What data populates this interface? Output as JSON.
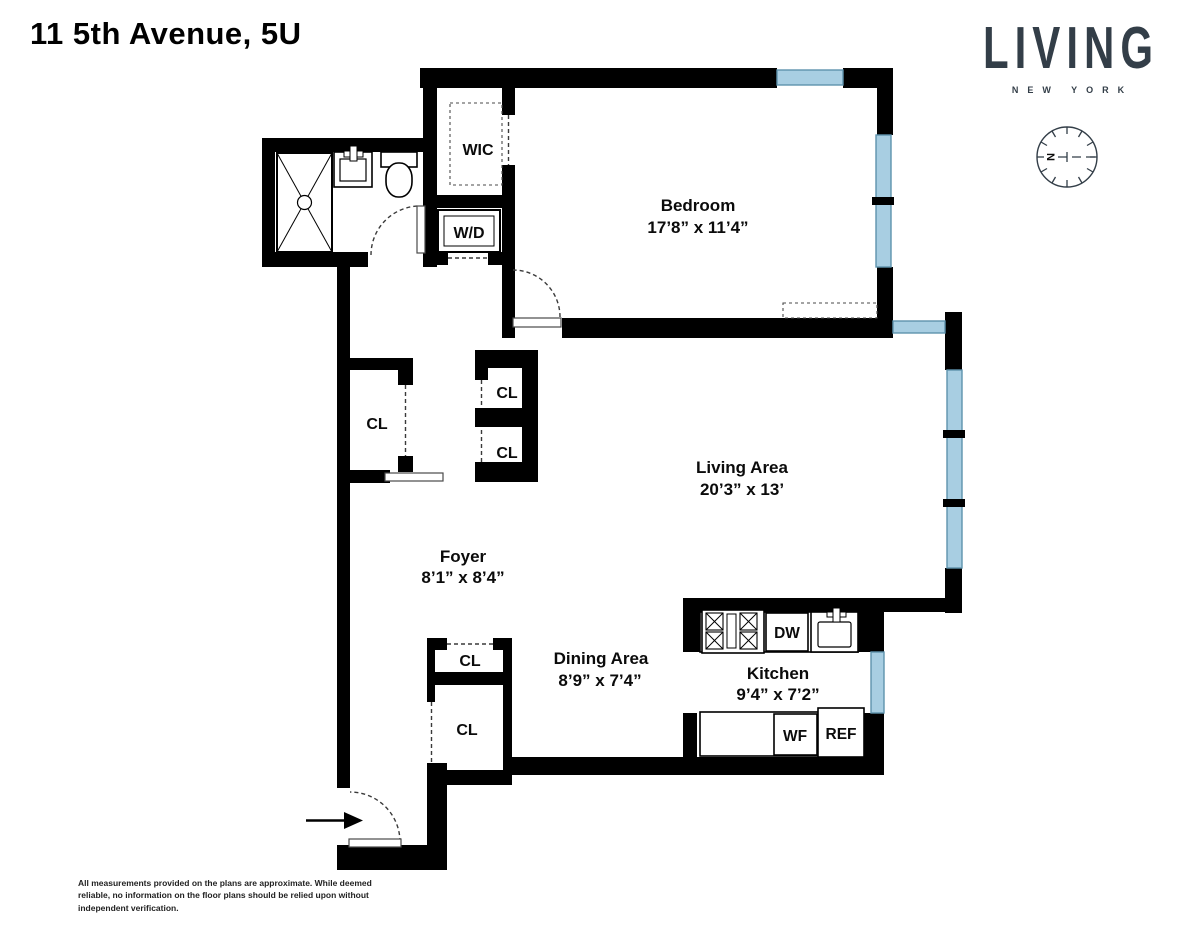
{
  "header": {
    "title": "11 5th Avenue, 5U"
  },
  "logo": {
    "brand": "LIVING",
    "tagline": "NEW YORK",
    "color": "#333E48"
  },
  "compass": {
    "north": "N"
  },
  "rooms": {
    "bedroom": {
      "name": "Bedroom",
      "dims": "17’8” x 11’4”"
    },
    "living": {
      "name": "Living Area",
      "dims": "20’3” x 13’"
    },
    "dining": {
      "name": "Dining Area",
      "dims": "8’9” x 7’4”"
    },
    "kitchen": {
      "name": "Kitchen",
      "dims": "9’4” x 7’2”"
    },
    "foyer": {
      "name": "Foyer",
      "dims": "8’1” x 8’4”"
    },
    "wic": {
      "name": "WIC"
    }
  },
  "labels": {
    "closet": "CL",
    "washer_dryer": "W/D",
    "dishwasher": "DW",
    "wine_fridge": "WF",
    "refrigerator": "REF"
  },
  "colors": {
    "wall": "#000000",
    "window_fill": "#A8CEE2",
    "window_stroke": "#5E93AD",
    "logo": "#333E48"
  },
  "footer": {
    "line1": "All measurements provided on the plans are approximate. While deemed",
    "line2": "reliable, no information on the floor plans should be relied upon without",
    "line3": "independent verification."
  }
}
